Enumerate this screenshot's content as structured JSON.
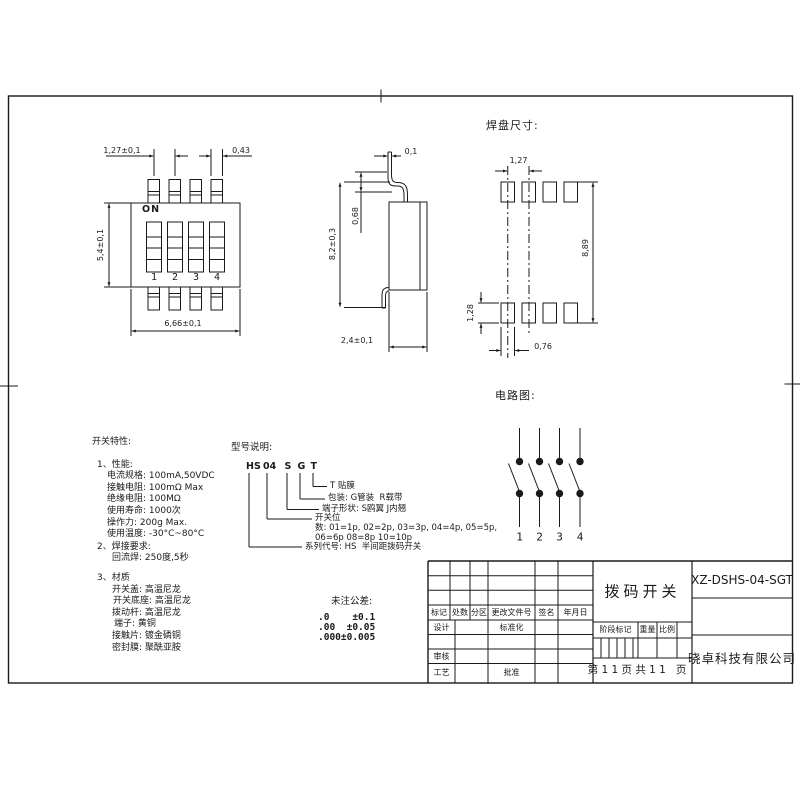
{
  "meta": {
    "ink": "#1a1a1a",
    "paper": "#ffffff"
  },
  "views": {
    "front": {
      "on_label": "ON",
      "switch_numbers": [
        "1",
        "2",
        "3",
        "4"
      ],
      "dims": {
        "pitch": "1,27±0,1",
        "pin_width": "0,43",
        "body_height": "5,4±0,1",
        "body_width": "6,66±0,1"
      }
    },
    "side": {
      "dims": {
        "pin_thickness": "0,1",
        "standoff": "0,68",
        "total_height": "8,2±0,3",
        "body_depth": "2,4±0,1"
      }
    },
    "pads": {
      "title": "焊盘尺寸:",
      "dims": {
        "pitch": "1,27",
        "row_span": "8,89",
        "pad_height": "1,28",
        "pad_width": "0,76"
      }
    },
    "circuit": {
      "title": "电路图:",
      "pole_numbers": [
        "1",
        "2",
        "3",
        "4"
      ]
    }
  },
  "characteristics": {
    "title": "开关特性:",
    "perf_heading": "1、性能:",
    "perf": [
      "电流规格: 100mA,50VDC",
      "接触电阻: 100mΩ Max",
      "绝缘电阻: 100MΩ",
      "使用寿命: 1000次",
      "操作力: 200g Max.",
      "使用温度: -30°C~80°C"
    ],
    "solder_heading": "2、焊接要求:",
    "solder": [
      "回流焊: 250度,5秒"
    ],
    "material_heading": "3、材质",
    "material": [
      "开关盖: 高温尼龙",
      "开关底座: 高温尼龙",
      "拨动杆: 高温尼龙",
      "端子: 黄铜",
      "接触片: 镀金磷铜",
      "密封膜: 聚酰亚胺"
    ]
  },
  "model_legend": {
    "title": "型号说明:",
    "code": {
      "series": "HS",
      "positions": "04",
      "terminal": "S",
      "packing": "G",
      "film": "T"
    },
    "desc_film": "T 贴膜",
    "desc_packing": "包装: G管装  R载带",
    "desc_terminal": "端子形状: S鸥翼 J内翘",
    "desc_positions_1": "开关位",
    "desc_positions_2": "数: 01=1p, 02=2p, 03=3p, 04=4p, 05=5p,",
    "desc_positions_3": "06=6p 08=8p 10=10p",
    "desc_series": "系列代号: HS  半间距拨码开关"
  },
  "tolerances": {
    "title": "未注公差:",
    "rows": [
      ".0    ±0.1",
      ".00  ±0.05",
      ".000±0.005"
    ]
  },
  "title_block": {
    "rev_headers": [
      "标记",
      "处数",
      "分区",
      "更改文件号",
      "签名",
      "年月日"
    ],
    "design": "设计",
    "standardization": "标准化",
    "check": "审核",
    "craft": "工艺",
    "approve": "批准",
    "stage_mark": "阶段标记",
    "weight": "重量",
    "scale": "比例",
    "drawing_title": "拨码开关",
    "page_info": "第 1 1 页 共 1 1   页",
    "part_number": "XZ-DSHS-04-SGT",
    "company": "晓卓科技有限公司"
  }
}
